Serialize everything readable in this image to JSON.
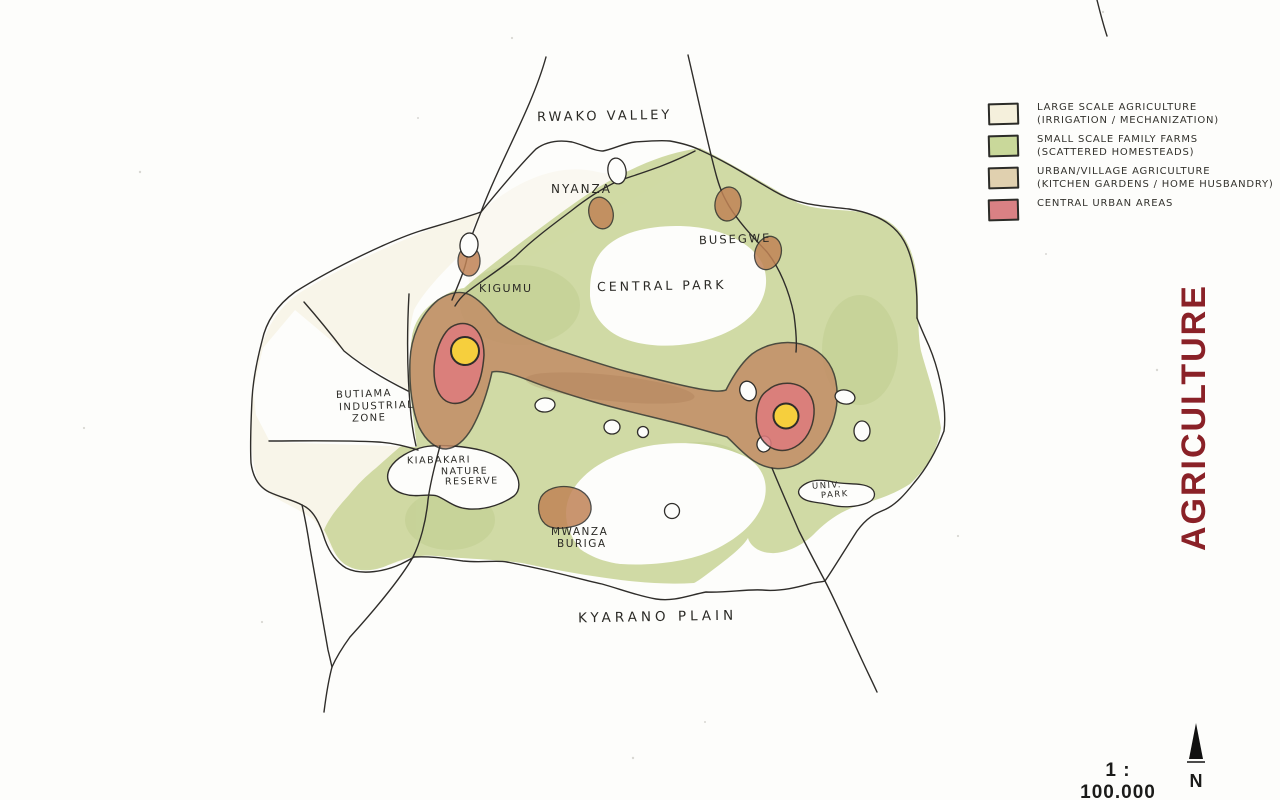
{
  "title": {
    "text": "AGRICULTURE"
  },
  "scale_bar": {
    "label": "1 : 100.000"
  },
  "compass": {
    "label": "N"
  },
  "legend": {
    "items": [
      {
        "label": "LARGE SCALE AGRICULTURE",
        "sublabel": "(IRRIGATION / MECHANIZATION)",
        "color": "#f5f0dc"
      },
      {
        "label": "SMALL SCALE FAMILY FARMS",
        "sublabel": "(SCATTERED HOMESTEADS)",
        "color": "#c9d89a"
      },
      {
        "label": "URBAN/VILLAGE AGRICULTURE",
        "sublabel": "(KITCHEN GARDENS / HOME HUSBANDRY)",
        "color": "#e0d0af"
      },
      {
        "label": "CENTRAL URBAN AREAS",
        "sublabel": "",
        "color": "#d98184"
      }
    ]
  },
  "map": {
    "labels": [
      {
        "name": "rwako-valley",
        "text": "RWAKO VALLEY"
      },
      {
        "name": "nyanza",
        "text": "NYANZA"
      },
      {
        "name": "busegwe",
        "text": "BUSEGWE"
      },
      {
        "name": "central-park",
        "text": "CENTRAL PARK"
      },
      {
        "name": "kigumu",
        "text": "KIGUMU"
      },
      {
        "name": "butiama-industrial-zone",
        "lines": [
          "BUTIAMA",
          "INDUSTRIAL",
          "ZONE"
        ]
      },
      {
        "name": "kiabakari-nature-reserve",
        "lines": [
          "KIABAKARI",
          "NATURE",
          "RESERVE"
        ]
      },
      {
        "name": "university-park",
        "lines": [
          "UNIV.",
          "PARK"
        ]
      },
      {
        "name": "mwanza-buriga",
        "lines": [
          "MWANZA",
          "BURIGA"
        ]
      },
      {
        "name": "kyarano-plain",
        "text": "KYARANO PLAIN"
      }
    ]
  },
  "colors": {
    "paper": "#fdfdfb",
    "cream": "#f4efdb",
    "green": "#cbd69b",
    "green_shade": "#a8bb70",
    "corridor": "#c28a64",
    "blob": "#c08255",
    "red": "#dd7c7e",
    "yellow": "#f6cf3d",
    "ink": "#2f2d2a",
    "title": "#8a2127",
    "label_ink": "#2b2a26"
  }
}
